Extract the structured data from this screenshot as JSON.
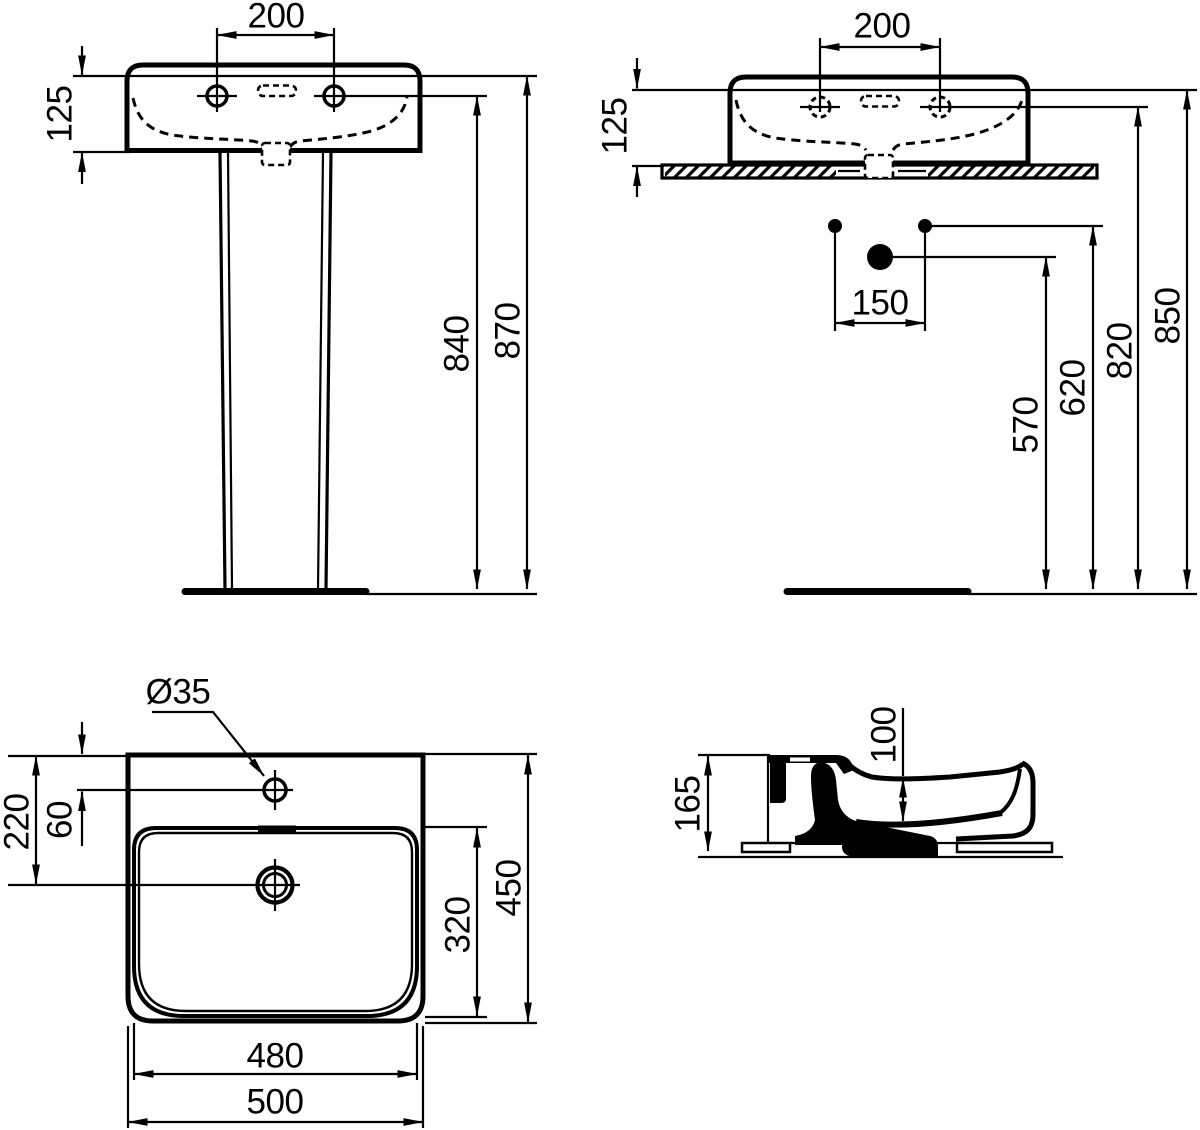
{
  "document": {
    "type": "technical-drawing",
    "subject": "Washbasin dimensional drawing: pedestal front view, wall-hung front view, plan view and side section"
  },
  "colors": {
    "ink": "#000000",
    "paper": "#ffffff"
  },
  "views": {
    "front_pedestal": {
      "label": "front view on pedestal",
      "dims": {
        "tap_hole_spacing": "200",
        "basin_rim_depth": "125",
        "tap_hole_height": "840",
        "rim_height": "870"
      }
    },
    "front_wall": {
      "label": "front view wall mounted",
      "dims": {
        "tap_hole_spacing": "200",
        "basin_rim_depth": "125",
        "fixing_bolt_spacing": "150",
        "trap_outlet_height": "570",
        "fixing_bolt_height": "620",
        "tap_hole_height": "820",
        "rim_height": "850"
      }
    },
    "plan": {
      "label": "plan view",
      "dims": {
        "tap_hole_diameter": "Ø35",
        "rim_to_drain": "220",
        "rim_to_tap_hole": "60",
        "bowl_inner_depth": "320",
        "overall_depth": "450",
        "bowl_inner_width": "480",
        "overall_width": "500"
      }
    },
    "side": {
      "label": "side section",
      "dims": {
        "overall_height": "165",
        "bowl_inner_height": "100"
      }
    }
  }
}
